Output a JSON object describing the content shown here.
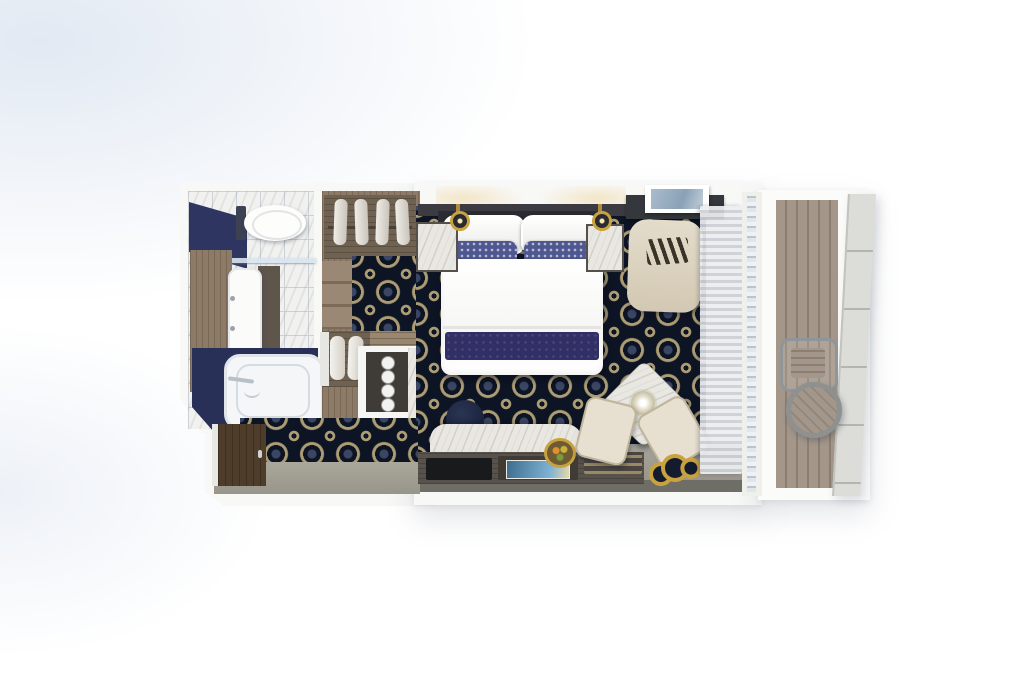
{
  "scene": {
    "type": "floorplan",
    "view": "top-down-3d-render",
    "subject": "cruise-suite-stateroom-with-balcony",
    "rooms": [
      {
        "name": "bathroom",
        "items": [
          "navy-accent-wall",
          "wall-hung-toilet",
          "marble-tile-floor",
          "glass-partition",
          "wood-cabinet",
          "vanity-sink",
          "bathtub",
          "tub-faucet"
        ]
      },
      {
        "name": "walk-in-wardrobe",
        "items": [
          "hanging-rail",
          "four-garments",
          "stepped-shelves",
          "two-bathrobes",
          "luggage-shelf"
        ]
      },
      {
        "name": "minibar-nook",
        "items": [
          "dark-cabinet",
          "four-glasses",
          "marble-counter"
        ]
      },
      {
        "name": "bedroom",
        "items": [
          "king-bed",
          "headboard",
          "euro-pillows",
          "patterned-pillows",
          "blue-accent-pillows",
          "white-duvet",
          "indigo-bed-runner",
          "nightstand-left",
          "nightstand-right",
          "gold-wall-lamp-left",
          "gold-wall-lamp-right",
          "octagon-pattern-carpet",
          "dark-desk",
          "framed-picture",
          "desk-chair"
        ]
      },
      {
        "name": "sitting-area",
        "items": [
          "marble-console",
          "navy-ottoman-pouf",
          "serving-tray",
          "magazine-tray",
          "blue-magazine",
          "slatted-tray",
          "fruit-bowl",
          "marble-side-table",
          "flower-centerpiece",
          "armchair-left",
          "armchair-right",
          "gold-floor-emblem"
        ]
      },
      {
        "name": "entry-hall",
        "items": [
          "entry-door",
          "gray-floor",
          "hall-carpet"
        ]
      },
      {
        "name": "balcony",
        "items": [
          "sheer-curtains",
          "sliding-glass-door",
          "teak-deck",
          "deck-chair",
          "round-teak-table",
          "railing-panel"
        ]
      }
    ]
  },
  "theme": {
    "wall": "#f8f8f6",
    "carpet-navy": "#0d1424",
    "carpet-gold": "#ab9c74",
    "carpet-ring": "#3d4968",
    "wood": "#8d7b68",
    "wood-dark": "#6f6252",
    "door-wood": "#4f3d2c",
    "navy-wall": "#2e3560",
    "tub-navy": "#283058",
    "marble": "#e9e7e1",
    "tile-line": "#ccd1d8",
    "gray-floor": "#a19e92",
    "wall-dark": "#6f6e66",
    "deck": "#a49689",
    "deck-gap": "#8c7f72",
    "rail": "#dcddd9",
    "rail-line": "#b4b5af",
    "cream": "#e7dfcf",
    "cream-edge": "#bfb49c",
    "desk-dark": "#34373c",
    "gold": "#c8a23f",
    "indigo": "#322f66",
    "pillow-navy": "#4f5790",
    "pillow-blue": "#93b8da",
    "glass": "#c3cdd7",
    "curtain-a": "#eceef0",
    "curtain-b": "#cdd0d5"
  }
}
